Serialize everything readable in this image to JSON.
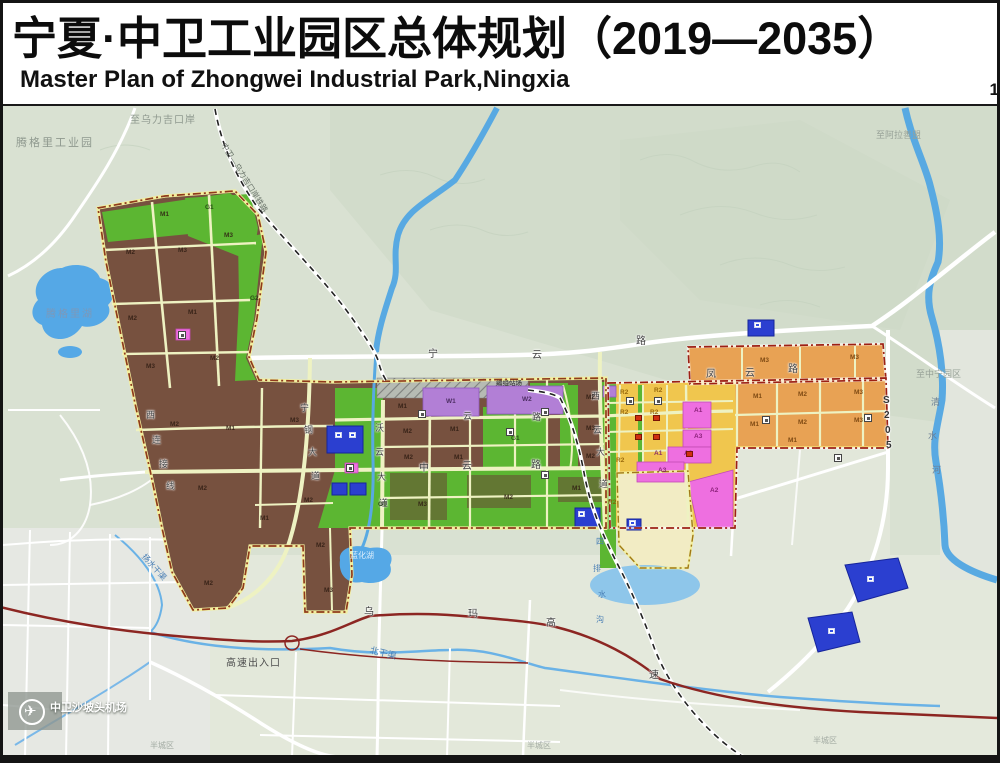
{
  "header": {
    "title": "宁夏·中卫工业园区总体规划（2019—2035）",
    "subtitle": "Master Plan of Zhongwei Industrial Park,Ningxia",
    "page_number": "1"
  },
  "palette": {
    "industrial_brown": "#77513f",
    "industrial_orange": "#e8a254",
    "residential_yellow": "#f0c64e",
    "public_pink": "#ee6fe0",
    "warehouse_purple": "#b27fd6",
    "green_space": "#5cb632",
    "utility_blue": "#2b3fd0",
    "reserve_pale_yellow": "#f2ecc4",
    "water_blue": "#58a9e2",
    "expressway_red": "#8c2622",
    "boundary_red": "#9c2014",
    "terrain": "#dce3d5"
  },
  "map": {
    "labels": [
      {
        "t": "腾格里工业园",
        "x": 16,
        "y": 138,
        "fs": 11,
        "c": "#8f998f",
        "ls": 2,
        "n": "label-tengger-industrial-park"
      },
      {
        "t": "至乌力吉口岸",
        "x": 130,
        "y": 116,
        "fs": 10,
        "c": "#8f998f",
        "ls": 1,
        "n": "label-to-wuliji-port"
      },
      {
        "t": "中卫—乌力吉口岸铁路",
        "x": 226,
        "y": 142,
        "fs": 8,
        "c": "#6a746a",
        "rot": 58,
        "n": "label-zhongwei-wuliji-railway"
      },
      {
        "t": "至阿拉善盟",
        "x": 876,
        "y": 131,
        "fs": 9,
        "c": "#97a197",
        "n": "label-to-alxa"
      },
      {
        "t": "至中宁园区",
        "x": 916,
        "y": 370,
        "fs": 9,
        "c": "#97a197",
        "n": "label-to-zhongning-park"
      },
      {
        "t": "半城区",
        "x": 150,
        "y": 742,
        "fs": 8,
        "c": "#a3aba3",
        "n": "label-district-1"
      },
      {
        "t": "半城区",
        "x": 527,
        "y": 742,
        "fs": 8,
        "c": "#a3aba3",
        "n": "label-district-2"
      },
      {
        "t": "半城区",
        "x": 813,
        "y": 737,
        "fs": 8,
        "c": "#a3aba3",
        "n": "label-district-3"
      },
      {
        "t": "腾格里湖",
        "x": 46,
        "y": 310,
        "fs": 10,
        "c": "#7d98b8",
        "ls": 2,
        "n": "label-tengger-lake"
      },
      {
        "t": "蓝化湖",
        "x": 350,
        "y": 552,
        "fs": 8,
        "c": "#dceefc",
        "n": "label-lanhua-lake"
      },
      {
        "t": "北干渠",
        "x": 371,
        "y": 646,
        "fs": 9,
        "c": "#4a7fb5",
        "rot": 14,
        "n": "label-north-main-canal"
      },
      {
        "t": "扬水干渠",
        "x": 146,
        "y": 553,
        "fs": 8,
        "c": "#4a7fb5",
        "rot": 48,
        "n": "label-pumping-canal"
      },
      {
        "t": "四",
        "x": 596,
        "y": 538,
        "fs": 8,
        "c": "#4a7fb5"
      },
      {
        "t": "排",
        "x": 593,
        "y": 565,
        "fs": 8,
        "c": "#4a7fb5"
      },
      {
        "t": "水",
        "x": 598,
        "y": 591,
        "fs": 8,
        "c": "#4a7fb5"
      },
      {
        "t": "沟",
        "x": 596,
        "y": 616,
        "fs": 8,
        "c": "#4a7fb5"
      },
      {
        "t": "清",
        "x": 931,
        "y": 398,
        "fs": 9,
        "c": "#6b7f95"
      },
      {
        "t": "水",
        "x": 928,
        "y": 432,
        "fs": 9,
        "c": "#6b7f95"
      },
      {
        "t": "河",
        "x": 932,
        "y": 466,
        "fs": 9,
        "c": "#6b7f95"
      },
      {
        "t": "宁",
        "x": 428,
        "y": 350,
        "fs": 10,
        "c": "#3f3f3f",
        "cls": "road"
      },
      {
        "t": "云",
        "x": 532,
        "y": 351,
        "fs": 10,
        "c": "#3f3f3f",
        "cls": "road"
      },
      {
        "t": "路",
        "x": 636,
        "y": 337,
        "fs": 10,
        "c": "#3f3f3f",
        "cls": "road"
      },
      {
        "t": "凤",
        "x": 706,
        "y": 370,
        "fs": 10,
        "c": "#3f3f3f",
        "cls": "road"
      },
      {
        "t": "云",
        "x": 745,
        "y": 369,
        "fs": 10,
        "c": "#3f3f3f",
        "cls": "road"
      },
      {
        "t": "路",
        "x": 788,
        "y": 365,
        "fs": 10,
        "c": "#3f3f3f",
        "cls": "road"
      },
      {
        "t": "云",
        "x": 463,
        "y": 412,
        "fs": 9,
        "c": "#3f3f3f",
        "cls": "road"
      },
      {
        "t": "路",
        "x": 532,
        "y": 413,
        "fs": 9,
        "c": "#3f3f3f",
        "cls": "road"
      },
      {
        "t": "中",
        "x": 419,
        "y": 464,
        "fs": 10,
        "c": "#3f3f3f",
        "cls": "road"
      },
      {
        "t": "云",
        "x": 462,
        "y": 462,
        "fs": 10,
        "c": "#3f3f3f",
        "cls": "road"
      },
      {
        "t": "路",
        "x": 531,
        "y": 461,
        "fs": 10,
        "c": "#3f3f3f",
        "cls": "road"
      },
      {
        "t": "宁",
        "x": 300,
        "y": 404,
        "fs": 9,
        "c": "#3f3f3f",
        "cls": "road"
      },
      {
        "t": "钢",
        "x": 304,
        "y": 426,
        "fs": 9,
        "c": "#3f3f3f",
        "cls": "road"
      },
      {
        "t": "大",
        "x": 308,
        "y": 448,
        "fs": 9,
        "c": "#3f3f3f",
        "cls": "road"
      },
      {
        "t": "道",
        "x": 311,
        "y": 472,
        "fs": 9,
        "c": "#3f3f3f",
        "cls": "road"
      },
      {
        "t": "沃",
        "x": 375,
        "y": 424,
        "fs": 9,
        "c": "#3f3f3f",
        "cls": "road"
      },
      {
        "t": "云",
        "x": 375,
        "y": 448,
        "fs": 9,
        "c": "#3f3f3f",
        "cls": "road"
      },
      {
        "t": "大",
        "x": 377,
        "y": 473,
        "fs": 9,
        "c": "#3f3f3f",
        "cls": "road"
      },
      {
        "t": "道",
        "x": 379,
        "y": 499,
        "fs": 9,
        "c": "#3f3f3f",
        "cls": "road"
      },
      {
        "t": "西",
        "x": 591,
        "y": 392,
        "fs": 9,
        "c": "#3f3f3f",
        "cls": "road"
      },
      {
        "t": "云",
        "x": 593,
        "y": 426,
        "fs": 9,
        "c": "#3f3f3f",
        "cls": "road"
      },
      {
        "t": "大",
        "x": 596,
        "y": 448,
        "fs": 9,
        "c": "#3f3f3f",
        "cls": "road"
      },
      {
        "t": "道",
        "x": 599,
        "y": 480,
        "fs": 9,
        "c": "#3f3f3f",
        "cls": "road"
      },
      {
        "t": "西",
        "x": 146,
        "y": 411,
        "fs": 9,
        "c": "#4a4a4a",
        "cls": "road"
      },
      {
        "t": "连",
        "x": 152,
        "y": 436,
        "fs": 9,
        "c": "#4a4a4a",
        "cls": "road"
      },
      {
        "t": "接",
        "x": 159,
        "y": 460,
        "fs": 9,
        "c": "#4a4a4a",
        "cls": "road"
      },
      {
        "t": "线",
        "x": 166,
        "y": 482,
        "fs": 9,
        "c": "#4a4a4a",
        "cls": "road"
      },
      {
        "t": "S",
        "x": 883,
        "y": 396,
        "fs": 10,
        "c": "#333",
        "b": 1,
        "cls": "road"
      },
      {
        "t": "2",
        "x": 884,
        "y": 411,
        "fs": 10,
        "c": "#333",
        "b": 1,
        "cls": "road"
      },
      {
        "t": "0",
        "x": 885,
        "y": 426,
        "fs": 10,
        "c": "#333",
        "b": 1,
        "cls": "road"
      },
      {
        "t": "5",
        "x": 886,
        "y": 441,
        "fs": 10,
        "c": "#333",
        "b": 1,
        "cls": "road"
      },
      {
        "t": "乌",
        "x": 364,
        "y": 608,
        "fs": 10,
        "c": "#3a3a3a",
        "cls": "road"
      },
      {
        "t": "玛",
        "x": 468,
        "y": 610,
        "fs": 10,
        "c": "#3a3a3a",
        "cls": "road"
      },
      {
        "t": "高",
        "x": 546,
        "y": 619,
        "fs": 10,
        "c": "#3a3a3a",
        "cls": "road"
      },
      {
        "t": "速",
        "x": 649,
        "y": 671,
        "fs": 10,
        "c": "#3a3a3a",
        "cls": "road"
      },
      {
        "t": "高速出入口",
        "x": 226,
        "y": 659,
        "fs": 10,
        "c": "#4e4e4e",
        "ls": 1,
        "n": "label-expressway-exit"
      },
      {
        "t": "编组站场",
        "x": 496,
        "y": 381,
        "fs": 6.5,
        "c": "#333",
        "n": "label-rail-yard"
      },
      {
        "t": "中卫沙坡头机场",
        "x": 50,
        "y": 703,
        "fs": 11,
        "c": "#ffffff",
        "cls": "airport",
        "n": "label-shapotou-airport"
      },
      {
        "t": "✈",
        "x": 24,
        "y": 704,
        "fs": 15,
        "c": "#ffffff",
        "n": "airplane-icon"
      },
      {
        "t": "M1",
        "x": 160,
        "y": 212,
        "fs": 6.5,
        "c": "#2e1c12",
        "cls": "parcel"
      },
      {
        "t": "G1",
        "x": 205,
        "y": 205,
        "fs": 6.5,
        "c": "#1e3c10",
        "cls": "parcel"
      },
      {
        "t": "M2",
        "x": 126,
        "y": 250,
        "fs": 6.5,
        "c": "#2e1c12",
        "cls": "parcel"
      },
      {
        "t": "M3",
        "x": 178,
        "y": 248,
        "fs": 6.5,
        "c": "#2e1c12",
        "cls": "parcel"
      },
      {
        "t": "M3",
        "x": 224,
        "y": 233,
        "fs": 6.5,
        "c": "#2e1c12",
        "cls": "parcel"
      },
      {
        "t": "M2",
        "x": 128,
        "y": 316,
        "fs": 6.5,
        "c": "#2e1c12",
        "cls": "parcel"
      },
      {
        "t": "M1",
        "x": 188,
        "y": 310,
        "fs": 6.5,
        "c": "#2e1c12",
        "cls": "parcel"
      },
      {
        "t": "M3",
        "x": 146,
        "y": 364,
        "fs": 6.5,
        "c": "#2e1c12",
        "cls": "parcel"
      },
      {
        "t": "M2",
        "x": 210,
        "y": 356,
        "fs": 6.5,
        "c": "#2e1c12",
        "cls": "parcel"
      },
      {
        "t": "G2",
        "x": 250,
        "y": 296,
        "fs": 6.5,
        "c": "#1e3c10",
        "cls": "parcel"
      },
      {
        "t": "M2",
        "x": 170,
        "y": 422,
        "fs": 6.5,
        "c": "#2e1c12",
        "cls": "parcel"
      },
      {
        "t": "M1",
        "x": 226,
        "y": 426,
        "fs": 6.5,
        "c": "#2e1c12",
        "cls": "parcel"
      },
      {
        "t": "M3",
        "x": 290,
        "y": 418,
        "fs": 6.5,
        "c": "#2e1c12",
        "cls": "parcel"
      },
      {
        "t": "M2",
        "x": 198,
        "y": 486,
        "fs": 6.5,
        "c": "#2e1c12",
        "cls": "parcel"
      },
      {
        "t": "M1",
        "x": 260,
        "y": 516,
        "fs": 6.5,
        "c": "#2e1c12",
        "cls": "parcel"
      },
      {
        "t": "M2",
        "x": 304,
        "y": 498,
        "fs": 6.5,
        "c": "#2e1c12",
        "cls": "parcel"
      },
      {
        "t": "M2",
        "x": 204,
        "y": 581,
        "fs": 6.5,
        "c": "#2e1c12",
        "cls": "parcel"
      },
      {
        "t": "M2",
        "x": 316,
        "y": 543,
        "fs": 6.5,
        "c": "#2e1c12",
        "cls": "parcel"
      },
      {
        "t": "M3",
        "x": 324,
        "y": 588,
        "fs": 6.5,
        "c": "#2e1c12",
        "cls": "parcel"
      },
      {
        "t": "M1",
        "x": 398,
        "y": 404,
        "fs": 6.5,
        "c": "#2e1c12",
        "cls": "parcel"
      },
      {
        "t": "M2",
        "x": 403,
        "y": 429,
        "fs": 6.5,
        "c": "#2e1c12",
        "cls": "parcel"
      },
      {
        "t": "M1",
        "x": 450,
        "y": 427,
        "fs": 6.5,
        "c": "#2e1c12",
        "cls": "parcel"
      },
      {
        "t": "M2",
        "x": 586,
        "y": 395,
        "fs": 6.5,
        "c": "#2e1c12",
        "cls": "parcel"
      },
      {
        "t": "G1",
        "x": 511,
        "y": 436,
        "fs": 6.5,
        "c": "#1e3c10",
        "cls": "parcel"
      },
      {
        "t": "M2",
        "x": 404,
        "y": 455,
        "fs": 6.5,
        "c": "#2e1c12",
        "cls": "parcel"
      },
      {
        "t": "M1",
        "x": 454,
        "y": 455,
        "fs": 6.5,
        "c": "#2e1c12",
        "cls": "parcel"
      },
      {
        "t": "M3",
        "x": 586,
        "y": 426,
        "fs": 6.5,
        "c": "#2e1c12",
        "cls": "parcel"
      },
      {
        "t": "M2",
        "x": 586,
        "y": 454,
        "fs": 6.5,
        "c": "#2e1c12",
        "cls": "parcel"
      },
      {
        "t": "M3",
        "x": 418,
        "y": 502,
        "fs": 6.5,
        "c": "#2e1c12",
        "cls": "parcel"
      },
      {
        "t": "M2",
        "x": 504,
        "y": 495,
        "fs": 6.5,
        "c": "#2e1c12",
        "cls": "parcel"
      },
      {
        "t": "G1",
        "x": 378,
        "y": 502,
        "fs": 6.5,
        "c": "#1e3c10",
        "cls": "parcel"
      },
      {
        "t": "M1",
        "x": 572,
        "y": 486,
        "fs": 6.5,
        "c": "#2e1c12",
        "cls": "parcel"
      },
      {
        "t": "W1",
        "x": 446,
        "y": 399,
        "fs": 6.5,
        "c": "#3c2050",
        "cls": "parcel"
      },
      {
        "t": "W2",
        "x": 522,
        "y": 397,
        "fs": 6.5,
        "c": "#3c2050",
        "cls": "parcel"
      },
      {
        "t": "R2",
        "x": 620,
        "y": 390,
        "fs": 6.5,
        "c": "#8a5a00",
        "cls": "parcel"
      },
      {
        "t": "R2",
        "x": 654,
        "y": 388,
        "fs": 6.5,
        "c": "#8a5a00",
        "cls": "parcel"
      },
      {
        "t": "R2",
        "x": 620,
        "y": 410,
        "fs": 6.5,
        "c": "#8a5a00",
        "cls": "parcel"
      },
      {
        "t": "R2",
        "x": 650,
        "y": 410,
        "fs": 6.5,
        "c": "#8a5a00",
        "cls": "parcel"
      },
      {
        "t": "R2",
        "x": 616,
        "y": 458,
        "fs": 6.5,
        "c": "#8a5a00",
        "cls": "parcel"
      },
      {
        "t": "R2",
        "x": 608,
        "y": 500,
        "fs": 6.5,
        "c": "#8a5a00",
        "cls": "parcel"
      },
      {
        "t": "A1",
        "x": 694,
        "y": 408,
        "fs": 6.5,
        "c": "#7a1468",
        "cls": "parcel"
      },
      {
        "t": "A3",
        "x": 694,
        "y": 434,
        "fs": 6.5,
        "c": "#7a1468",
        "cls": "parcel"
      },
      {
        "t": "A2",
        "x": 684,
        "y": 451,
        "fs": 6.5,
        "c": "#7a1468",
        "cls": "parcel"
      },
      {
        "t": "A1",
        "x": 654,
        "y": 451,
        "fs": 6.5,
        "c": "#7a1468",
        "cls": "parcel"
      },
      {
        "t": "A3",
        "x": 658,
        "y": 468,
        "fs": 6.5,
        "c": "#7a1468",
        "cls": "parcel"
      },
      {
        "t": "A2",
        "x": 710,
        "y": 488,
        "fs": 6.5,
        "c": "#7a1468",
        "cls": "parcel"
      },
      {
        "t": "M3",
        "x": 760,
        "y": 358,
        "fs": 6.5,
        "c": "#6e3c08",
        "cls": "parcel"
      },
      {
        "t": "M3",
        "x": 850,
        "y": 355,
        "fs": 6.5,
        "c": "#6e3c08",
        "cls": "parcel"
      },
      {
        "t": "M1",
        "x": 753,
        "y": 394,
        "fs": 6.5,
        "c": "#6e3c08",
        "cls": "parcel"
      },
      {
        "t": "M2",
        "x": 798,
        "y": 392,
        "fs": 6.5,
        "c": "#6e3c08",
        "cls": "parcel"
      },
      {
        "t": "M3",
        "x": 854,
        "y": 390,
        "fs": 6.5,
        "c": "#6e3c08",
        "cls": "parcel"
      },
      {
        "t": "M1",
        "x": 750,
        "y": 422,
        "fs": 6.5,
        "c": "#6e3c08",
        "cls": "parcel"
      },
      {
        "t": "M2",
        "x": 798,
        "y": 420,
        "fs": 6.5,
        "c": "#6e3c08",
        "cls": "parcel"
      },
      {
        "t": "M3",
        "x": 854,
        "y": 418,
        "fs": 6.5,
        "c": "#6e3c08",
        "cls": "parcel"
      },
      {
        "t": "M1",
        "x": 788,
        "y": 438,
        "fs": 6.5,
        "c": "#6e3c08",
        "cls": "parcel"
      }
    ],
    "icons": [
      {
        "x": 418,
        "y": 410,
        "type": "box"
      },
      {
        "x": 541,
        "y": 408,
        "type": "box"
      },
      {
        "x": 762,
        "y": 416,
        "type": "box"
      },
      {
        "x": 506,
        "y": 428,
        "type": "box"
      },
      {
        "x": 541,
        "y": 471,
        "type": "box"
      },
      {
        "x": 864,
        "y": 414,
        "type": "box"
      },
      {
        "x": 834,
        "y": 454,
        "type": "box"
      },
      {
        "x": 626,
        "y": 397,
        "type": "box"
      },
      {
        "x": 654,
        "y": 397,
        "type": "box"
      },
      {
        "x": 346,
        "y": 464,
        "type": "box"
      },
      {
        "x": 178,
        "y": 331,
        "type": "box"
      },
      {
        "x": 335,
        "y": 432,
        "type": "bluebox"
      },
      {
        "x": 349,
        "y": 432,
        "type": "bluebox"
      },
      {
        "x": 578,
        "y": 511,
        "type": "bluebox"
      },
      {
        "x": 754,
        "y": 322,
        "type": "bluebox"
      },
      {
        "x": 867,
        "y": 576,
        "type": "bluebox"
      },
      {
        "x": 828,
        "y": 628,
        "type": "bluebox"
      },
      {
        "x": 629,
        "y": 520,
        "type": "bluebox"
      },
      {
        "x": 635,
        "y": 415,
        "type": "red"
      },
      {
        "x": 653,
        "y": 415,
        "type": "red"
      },
      {
        "x": 635,
        "y": 434,
        "type": "red"
      },
      {
        "x": 653,
        "y": 434,
        "type": "red"
      },
      {
        "x": 686,
        "y": 451,
        "type": "red"
      }
    ]
  }
}
